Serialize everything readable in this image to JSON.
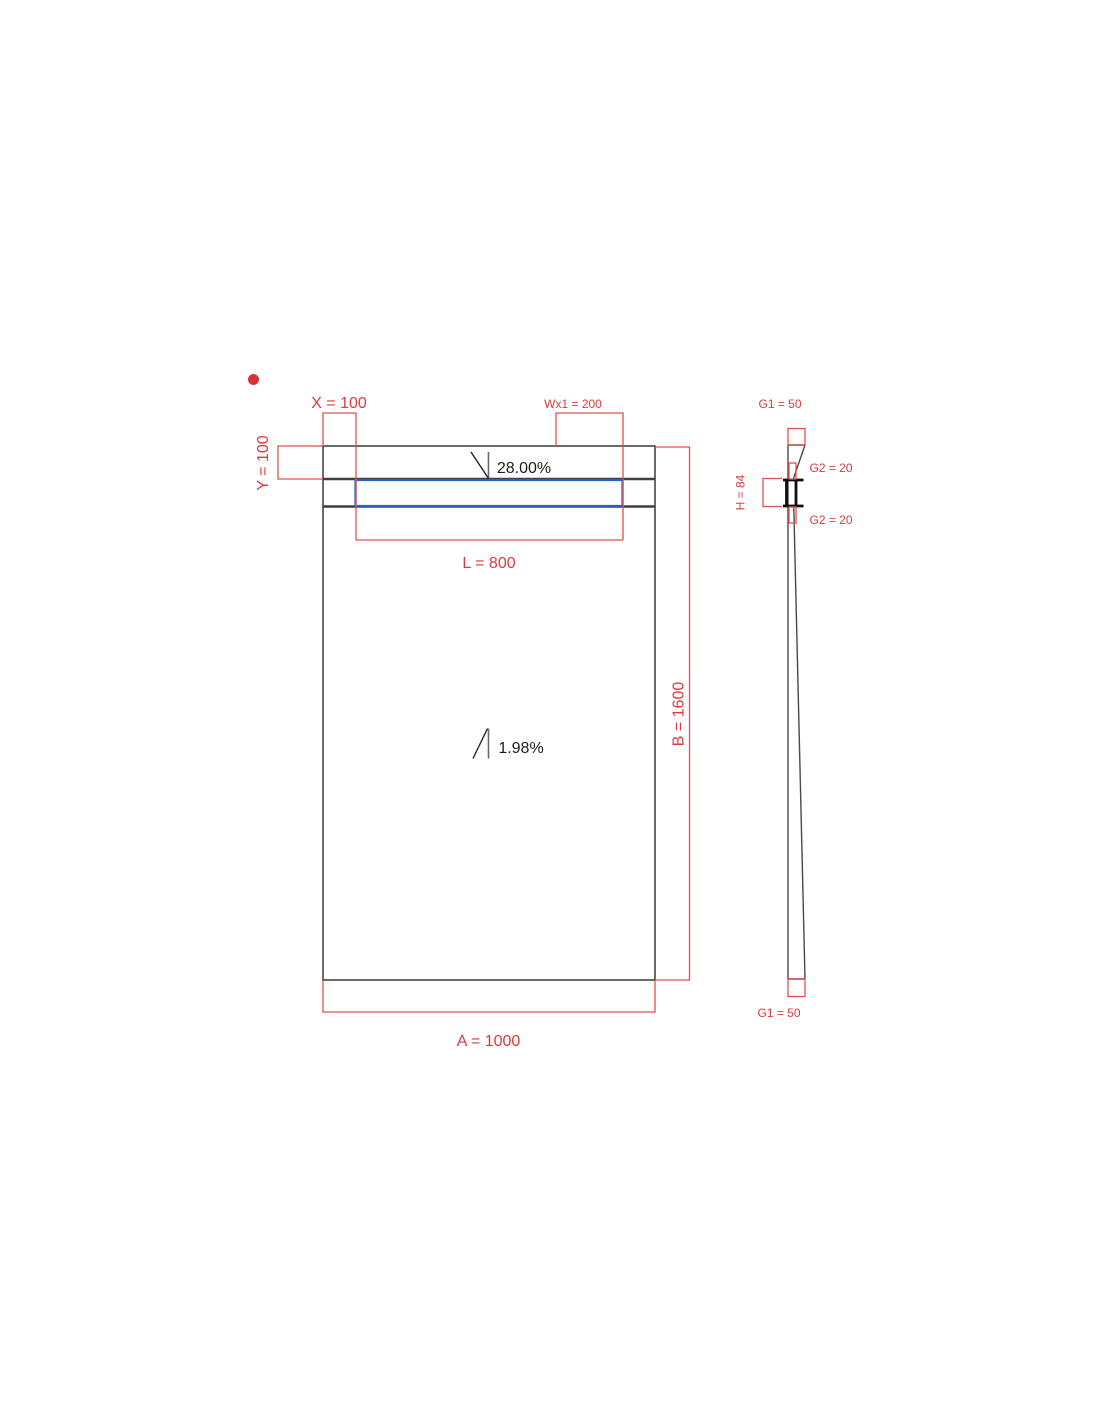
{
  "drawing": {
    "colors": {
      "dimension_red": "#dd3a3c",
      "channel_blue": "#2160cd",
      "outline_black": "#2b2b2b",
      "profile_black": "#0e0e0e",
      "marker_dot": "#d93336"
    },
    "plan": {
      "labels": {
        "x_offset": "X = 100",
        "y_offset": "Y = 100",
        "wx1": "Wx1 = 200",
        "channel_length": "L = 800",
        "width": "A = 1000",
        "length": "B = 1600",
        "slope_upper": "28.00%",
        "slope_lower": "1.98%"
      }
    },
    "side": {
      "labels": {
        "g1_top": "G1 = 50",
        "g2_upper": "G2 = 20",
        "height": "H = 84",
        "g2_lower": "G2 = 20",
        "g1_bottom": "G1 = 50"
      }
    }
  }
}
